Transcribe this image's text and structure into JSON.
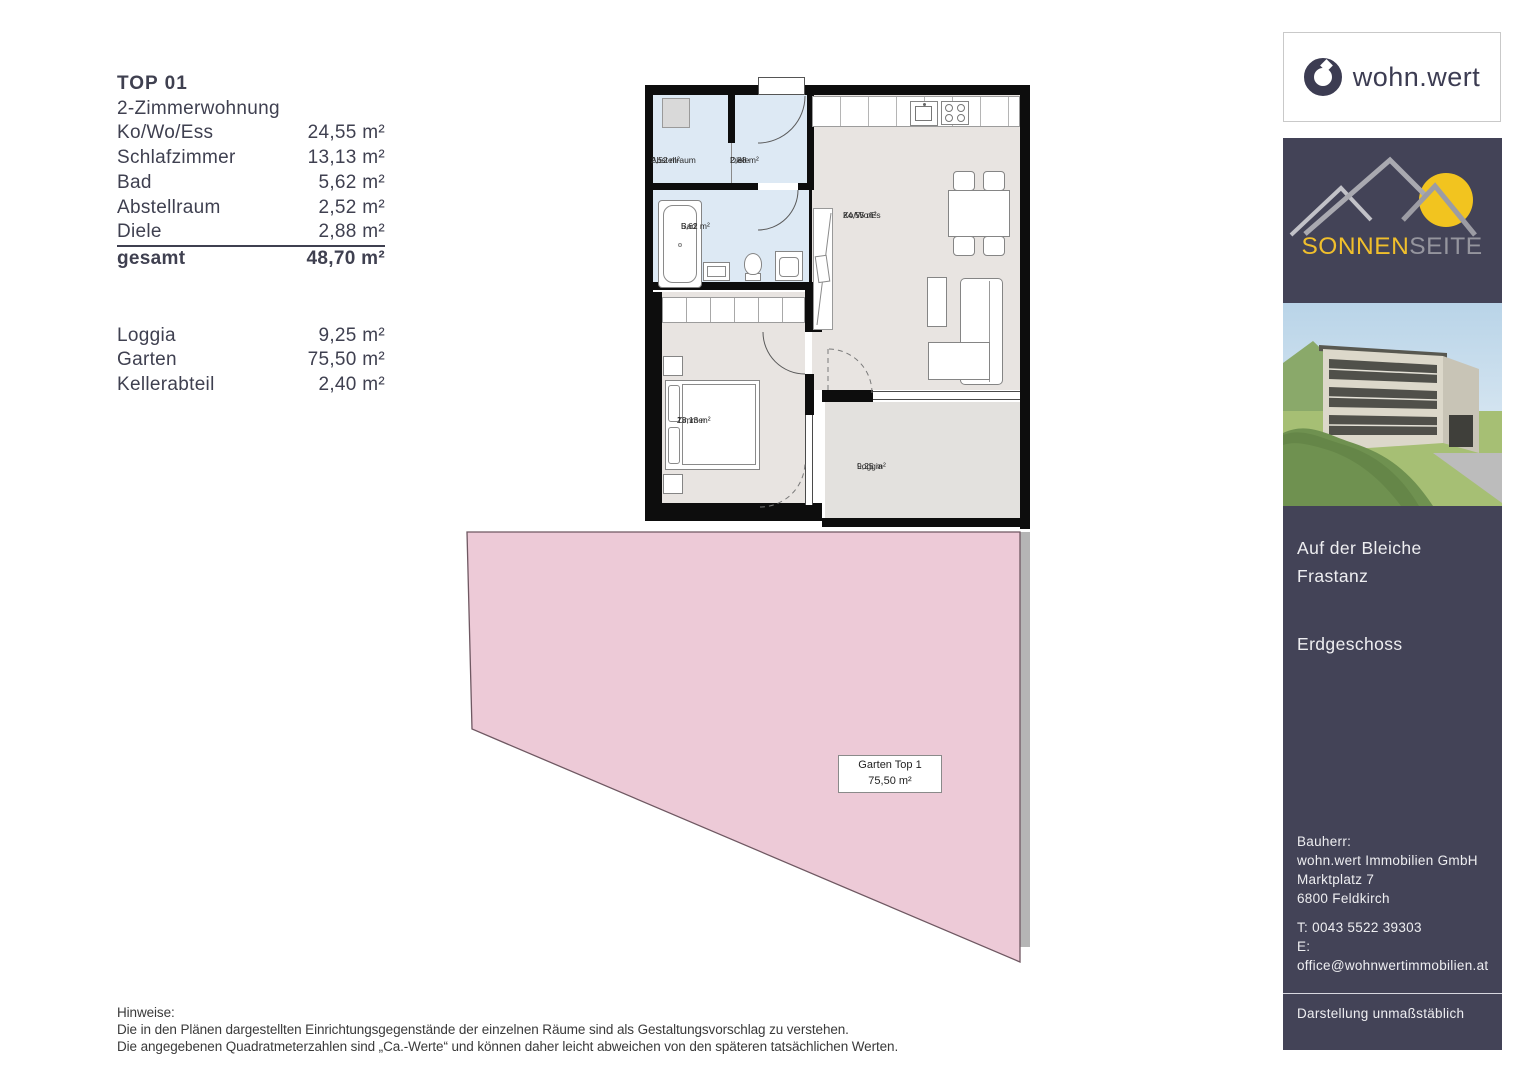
{
  "area_table": {
    "title": "TOP 01",
    "subtitle": "2-Zimmerwohnung",
    "rows": [
      {
        "label": "Ko/Wo/Ess",
        "value": "24,55 m²"
      },
      {
        "label": "Schlafzimmer",
        "value": "13,13 m²"
      },
      {
        "label": "Bad",
        "value": "5,62 m²"
      },
      {
        "label": "Abstellraum",
        "value": "2,52 m²"
      },
      {
        "label": "Diele",
        "value": "2,88 m²"
      }
    ],
    "total": {
      "label": "gesamt",
      "value": "48,70 m²"
    },
    "extras": [
      {
        "label": "Loggia",
        "value": "9,25 m²"
      },
      {
        "label": "Garten",
        "value": "75,50 m²"
      },
      {
        "label": "Kellerabteil",
        "value": "2,40 m²"
      }
    ]
  },
  "floor_plan": {
    "rooms": {
      "abstellraum": {
        "name": "Abstellraum",
        "area": "2,52 m²"
      },
      "diele": {
        "name": "Diele",
        "area": "2,88 m²"
      },
      "bad": {
        "name": "Bad",
        "area": "5,62 m²"
      },
      "kowoes": {
        "name": "Ko/Wo/Es",
        "area": "24,55 m²"
      },
      "zimmer": {
        "name": "Zimmer",
        "area": "13,13 m²"
      },
      "loggia": {
        "name": "Loggia",
        "area": "9,25 m²"
      }
    },
    "garden": {
      "name": "Garten Top 1",
      "area": "75,50 m²"
    }
  },
  "sidebar": {
    "logo": {
      "text": "wohn.wert"
    },
    "brand": {
      "part1": "SONNEN",
      "part2": "SEITE"
    },
    "project": {
      "address_line1": "Auf der Bleiche",
      "address_line2": "Frastanz",
      "floor": "Erdgeschoss"
    },
    "builder": {
      "heading": "Bauherr:",
      "company": "wohn.wert Immobilien GmbH",
      "street": "Marktplatz 7",
      "city": "6800 Feldkirch",
      "phone": "T: 0043 5522 39303",
      "email": "E: office@wohnwertimmobilien.at"
    },
    "disclaimer": "Darstellung unmaßstäblich"
  },
  "footer": {
    "heading": "Hinweise:",
    "line1": "Die in den Plänen dargestellten Einrichtungsgegenstände der einzelnen Räume sind als Gestaltungsvorschlag zu verstehen.",
    "line2": "Die angegebenen Quadratmeterzahlen sind „Ca.-Werte“ und können daher leicht abweichen von den späteren tatsächlichen Werten."
  },
  "colors": {
    "accent_navy": "#434357",
    "logo_navy": "#3c3c52",
    "garden_pink": "#edcad7",
    "room_blue": "#dde9f4",
    "room_gray": "#e8e4e1",
    "sun_yellow": "#f2c41f"
  }
}
